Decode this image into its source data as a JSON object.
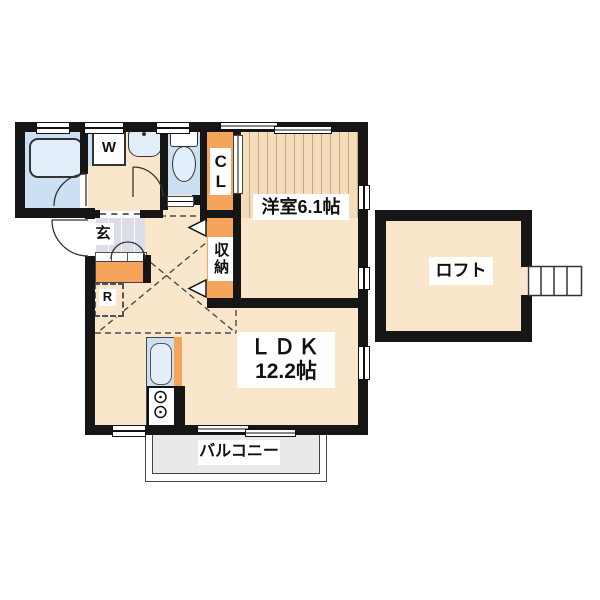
{
  "title": "1LDK apartment floor plan with loft",
  "colors": {
    "wall": "#161616",
    "orange": "#F5A45C",
    "room_blue": "#CCE0F4",
    "fixture_blue": "#E2EEFA",
    "floor": "#FAE7CB",
    "wood": "#F3DDBD",
    "wood_line": "#C9A87C",
    "tile": "#DBDEE9",
    "balcony": "#E9E9E9"
  },
  "labels": {
    "washer": "W",
    "closet": "CL",
    "entrance": "玄",
    "refrigerator": "R",
    "storage": "収納",
    "western_room": "洋室6.1帖",
    "ldk_name": "ＬＤＫ",
    "ldk_size": "12.2帖",
    "loft": "ロフト",
    "balcony": "バルコニー"
  }
}
